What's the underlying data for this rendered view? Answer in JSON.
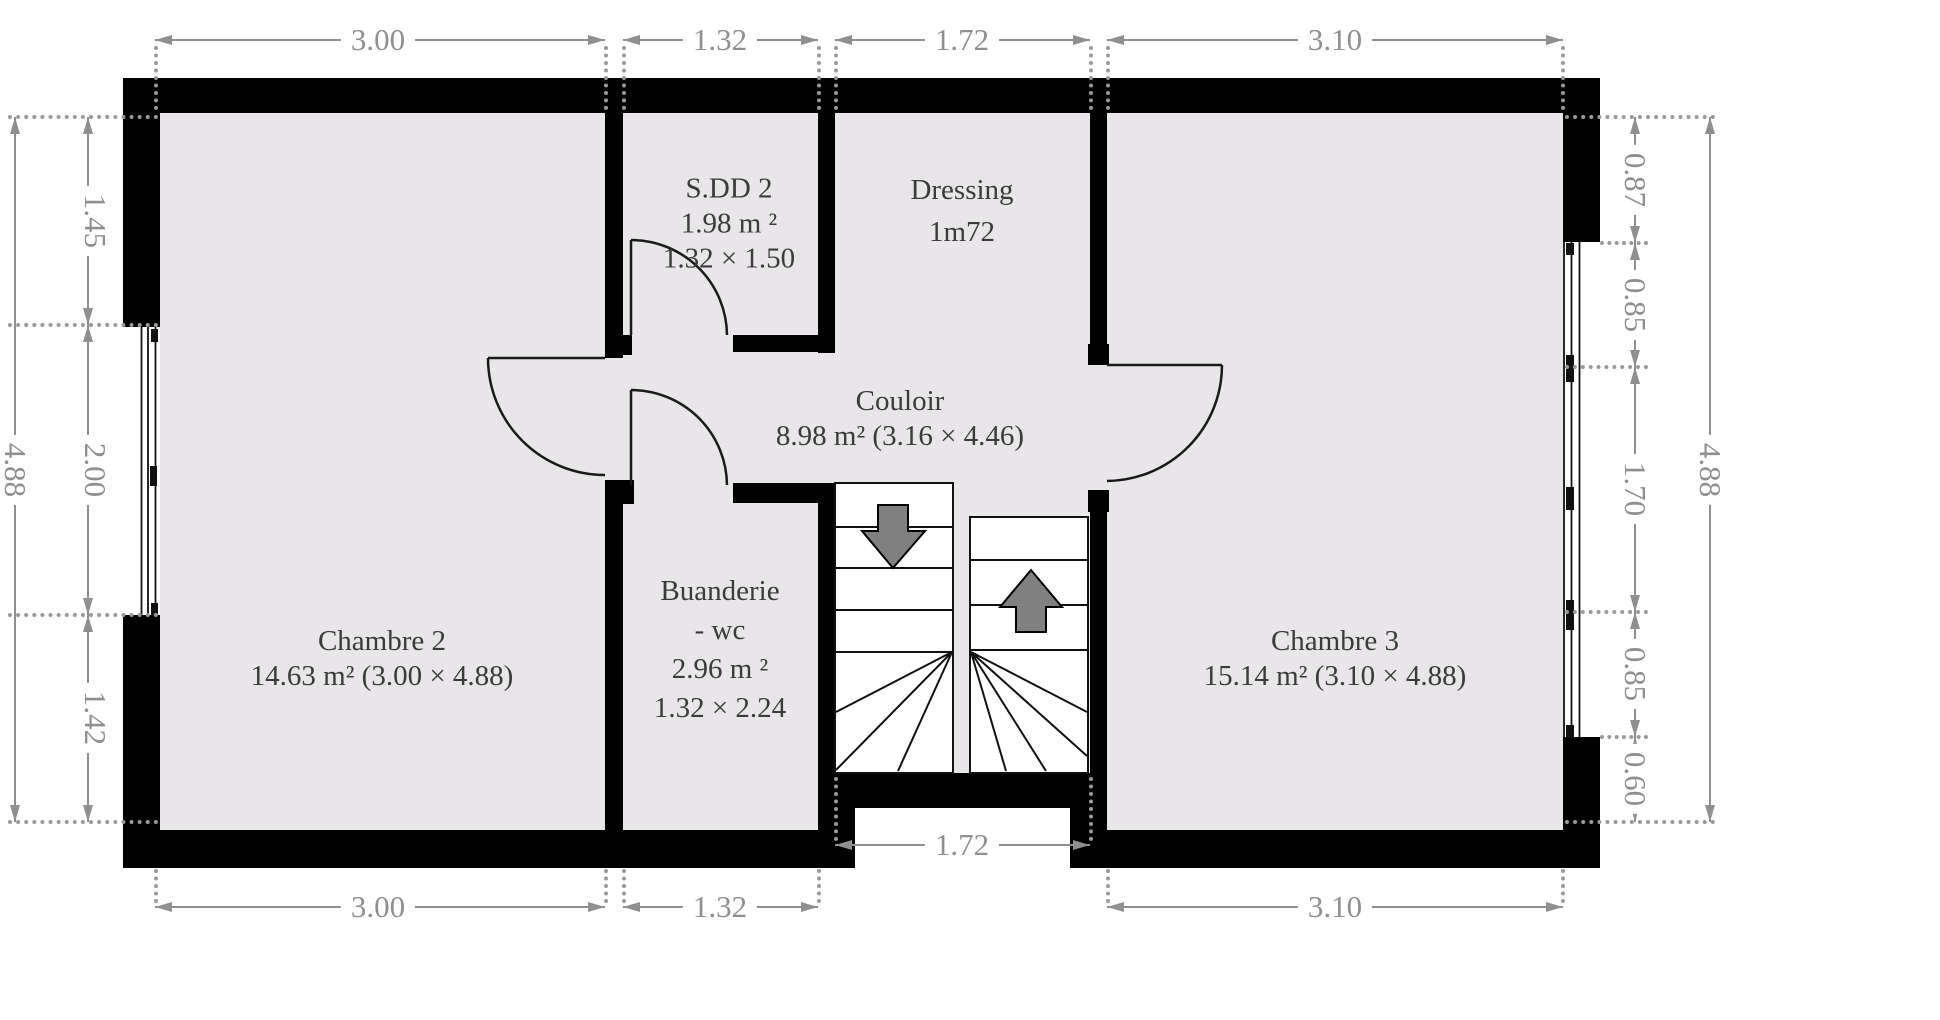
{
  "plan": {
    "title": "floor-plan-etage",
    "colors": {
      "background": "#ffffff",
      "floor": "#e8e6e8",
      "wall": "#000000",
      "dim": "#8f8f8f",
      "text": "#3b3b3b",
      "arrow": "#808080",
      "door": "#1a1a1a"
    }
  },
  "rooms": [
    {
      "id": "chambre2",
      "lines": [
        "Chambre 2",
        "14.63 m² (3.00 × 4.88)"
      ]
    },
    {
      "id": "sdd2",
      "lines": [
        "S.DD 2",
        "1.98 m ²",
        "1.32 × 1.50"
      ]
    },
    {
      "id": "dressing",
      "lines": [
        "Dressing",
        "1m72"
      ]
    },
    {
      "id": "couloir",
      "lines": [
        "Couloir",
        "8.98 m² (3.16 × 4.46)"
      ]
    },
    {
      "id": "buanderie",
      "lines": [
        "Buanderie",
        "- wc",
        "2.96 m ²",
        "1.32 × 2.24"
      ]
    },
    {
      "id": "chambre3",
      "lines": [
        "Chambre 3",
        "15.14 m² (3.10 × 4.88)"
      ]
    }
  ],
  "dimensions": {
    "top": [
      "3.00",
      "1.32",
      "1.72",
      "3.10"
    ],
    "bottom": [
      "3.00",
      "1.32",
      "3.10"
    ],
    "bottom_inner": "1.72",
    "left_outer": "4.88",
    "left_inner": [
      "1.45",
      "2.00",
      "1.42"
    ],
    "right_outer": "4.88",
    "right_inner": [
      "0.87",
      "0.85",
      "1.70",
      "0.85",
      "0.60"
    ]
  }
}
